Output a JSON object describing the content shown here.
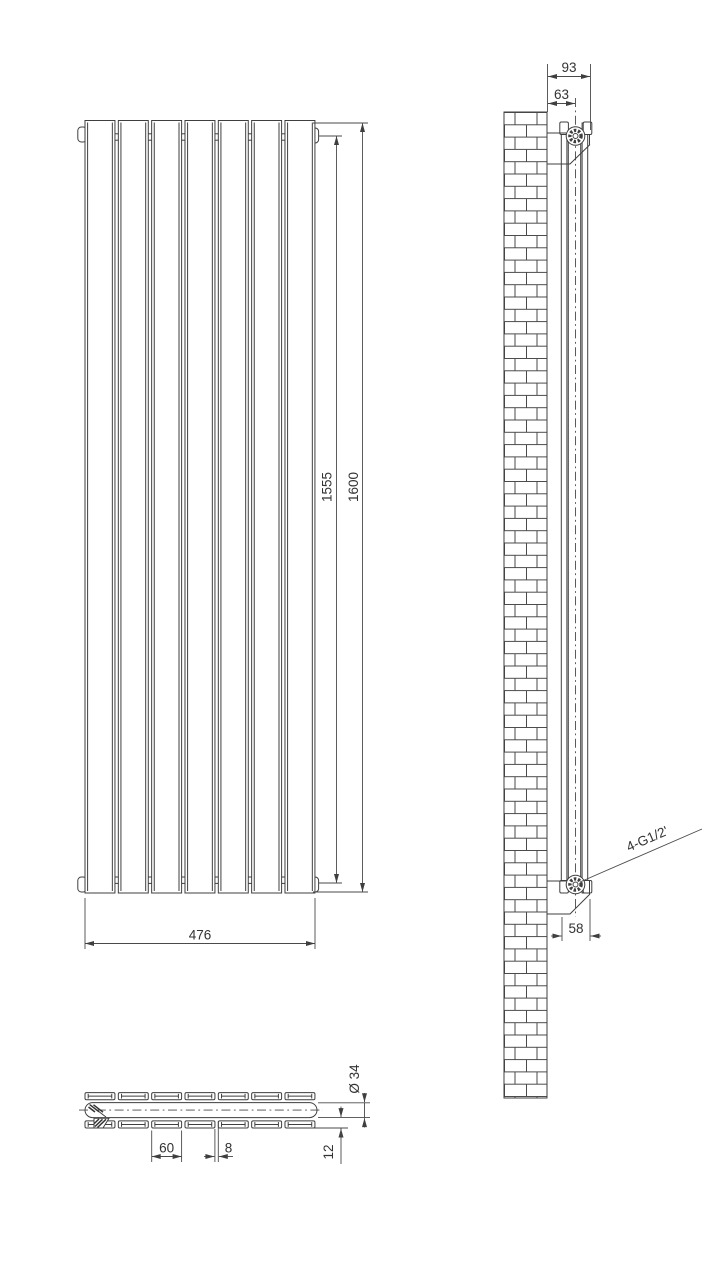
{
  "drawing_title": "vertical-panel-radiator-technical-drawing",
  "colors": {
    "line": "#3f3f3f",
    "text": "#333333",
    "background": "#ffffff"
  },
  "front_view": {
    "panel_count": 7,
    "dim_width": "476",
    "dim_height_centers": "1555",
    "dim_height_overall": "1600"
  },
  "side_view": {
    "dim_wall_to_front": "93",
    "dim_wall_to_center": "63",
    "dim_depth": "58",
    "connections_label": "4-G1/2'"
  },
  "plan_view": {
    "panel_count": 7,
    "dim_panel_width": "60",
    "dim_panel_gap": "8",
    "dim_tube_diameter": "Ø 34",
    "dim_panel_depth": "12"
  }
}
